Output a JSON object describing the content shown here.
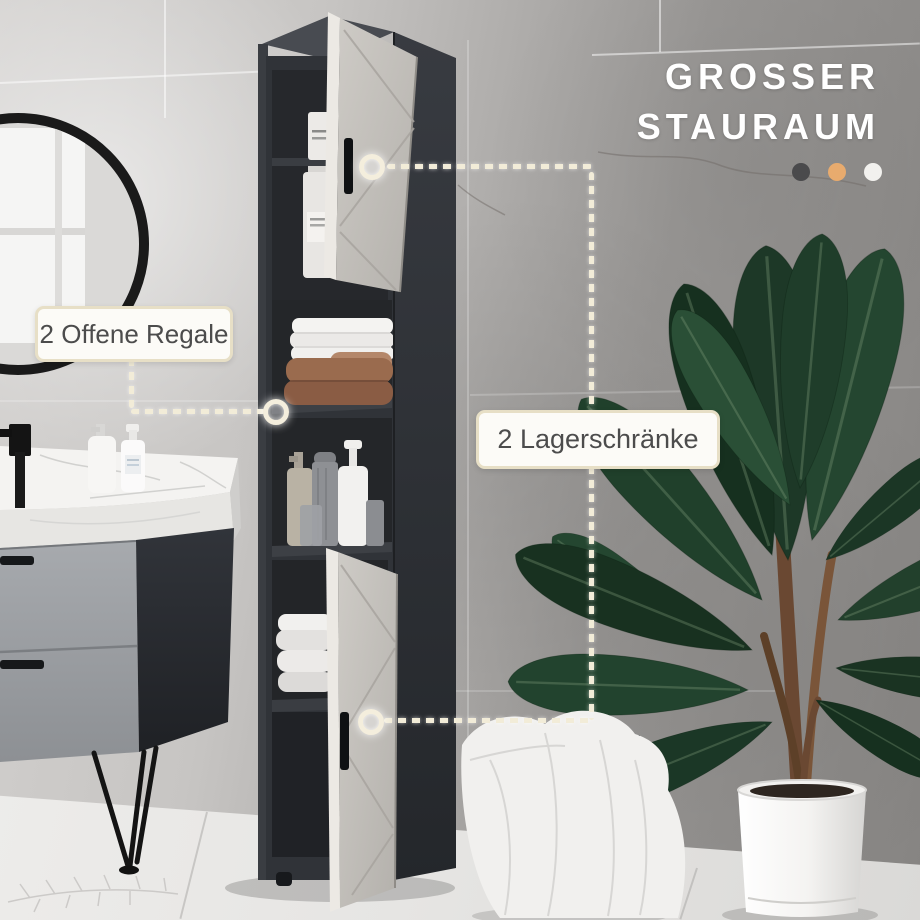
{
  "headline": {
    "line1": "GROSSER",
    "line2": "STAURAUM",
    "color": "#ffffff"
  },
  "accent_dots": [
    {
      "name": "dot-dark",
      "color": "#4a4a4c",
      "css": "background:#4a4a4c"
    },
    {
      "name": "dot-orange",
      "color": "#e8ab6e",
      "css": "background:#e8ab6e"
    },
    {
      "name": "dot-light",
      "color": "#f2f1ee",
      "css": "background:#f2f1ee"
    }
  ],
  "annotations": {
    "open_shelves": {
      "label": "2 Offene Regale"
    },
    "storage_cabinets": {
      "label": "2 Lagerschränke"
    }
  },
  "style": {
    "annotation_border": "#e7dfc6",
    "annotation_bg": "#fcfbf7",
    "annotation_text": "#4c4c4c",
    "connector_color": "#f2ecd8"
  }
}
